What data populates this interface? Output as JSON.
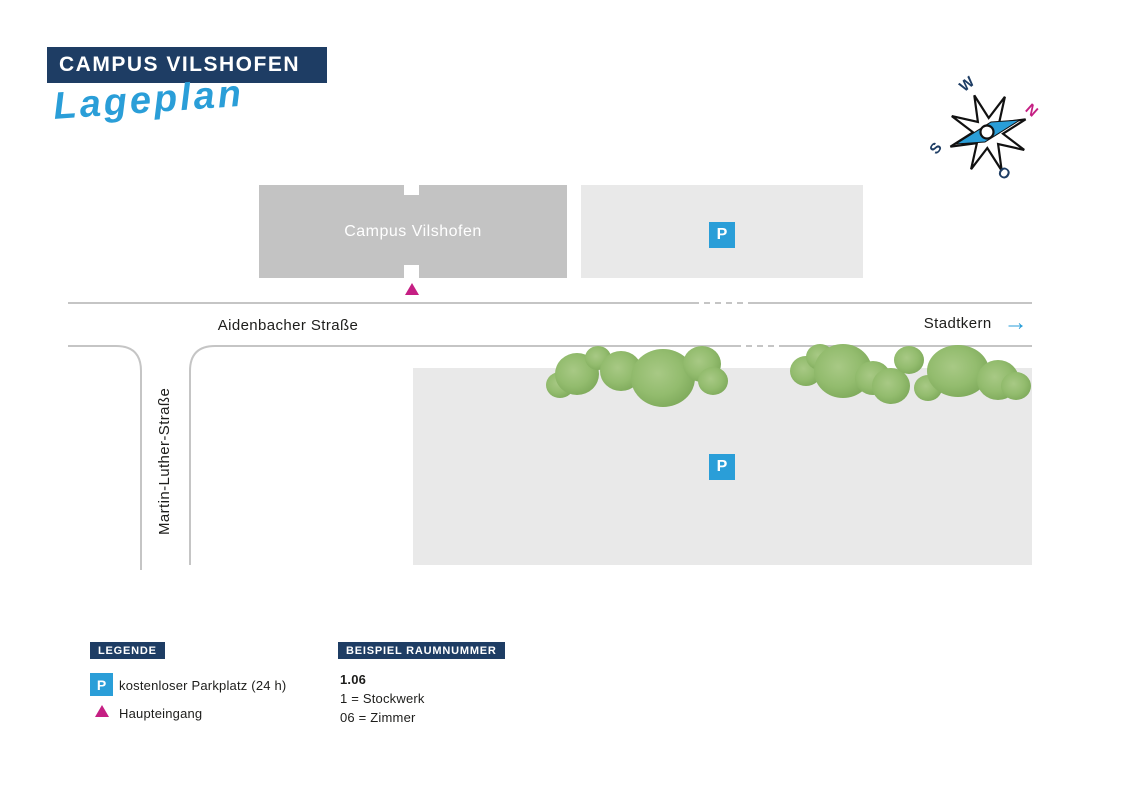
{
  "colors": {
    "navy": "#1e3d64",
    "accent_blue": "#2a9ed8",
    "accent_pink": "#c51f83",
    "building_gray": "#c3c3c3",
    "parking_gray": "#e9e9e9",
    "street_line_gray": "#c5c5c5",
    "tree_green_light": "#a3c580",
    "tree_green_dark": "#7aa657"
  },
  "header": {
    "title": "CAMPUS VILSHOFEN",
    "subtitle": "Lageplan"
  },
  "compass": {
    "north": "N",
    "east": "O",
    "south": "S",
    "west": "W"
  },
  "map": {
    "building_label": "Campus Vilshofen",
    "parking_symbol": "P",
    "street_horizontal": "Aidenbacher Straße",
    "street_vertical": "Martin-Luther-Straße",
    "direction_label": "Stadtkern",
    "arrow_right_symbol": "→"
  },
  "legend": {
    "title": "LEGENDE",
    "items": [
      {
        "symbol": "P",
        "label": "kostenloser Parkplatz (24 h)"
      },
      {
        "symbol": "▲",
        "label": "Haupteingang"
      }
    ]
  },
  "room_example": {
    "title": "BEISPIEL RAUMNUMMER",
    "lines": [
      "1.06",
      "1 = Stockwerk",
      "06 = Zimmer"
    ]
  }
}
